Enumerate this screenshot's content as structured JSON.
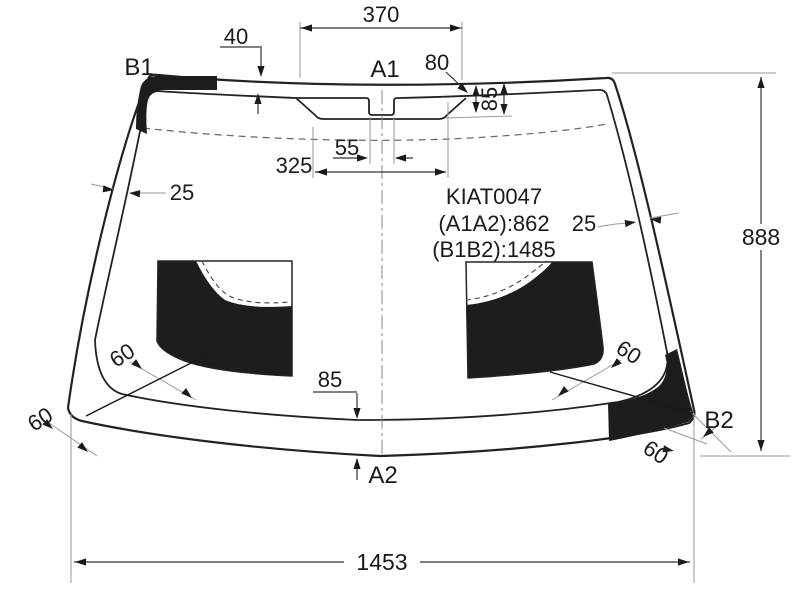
{
  "page": {
    "background": "#ffffff",
    "line_color": "#222222",
    "aux_line_color": "#999999",
    "fill_color": "#1d1d1d"
  },
  "diagram": {
    "part_code": "KIAT0047",
    "measure_a": "(A1A2):862",
    "measure_b": "(B1B2):1485",
    "points": {
      "a1": "A1",
      "a2": "A2",
      "b1": "B1",
      "b2": "B2"
    },
    "dimensions": {
      "top_frit_width": "370",
      "top_band": "40",
      "sensor_offset": "80",
      "top_frit_height": "85",
      "notch_width": "55",
      "frit_base": "325",
      "left_band": "25",
      "right_band": "25",
      "overall_height": "888",
      "bottom_band": "85",
      "left_mid_offset": "60",
      "left_corner_band": "60",
      "right_mid_offset": "60",
      "right_corner_band": "60",
      "overall_width": "1453"
    }
  }
}
